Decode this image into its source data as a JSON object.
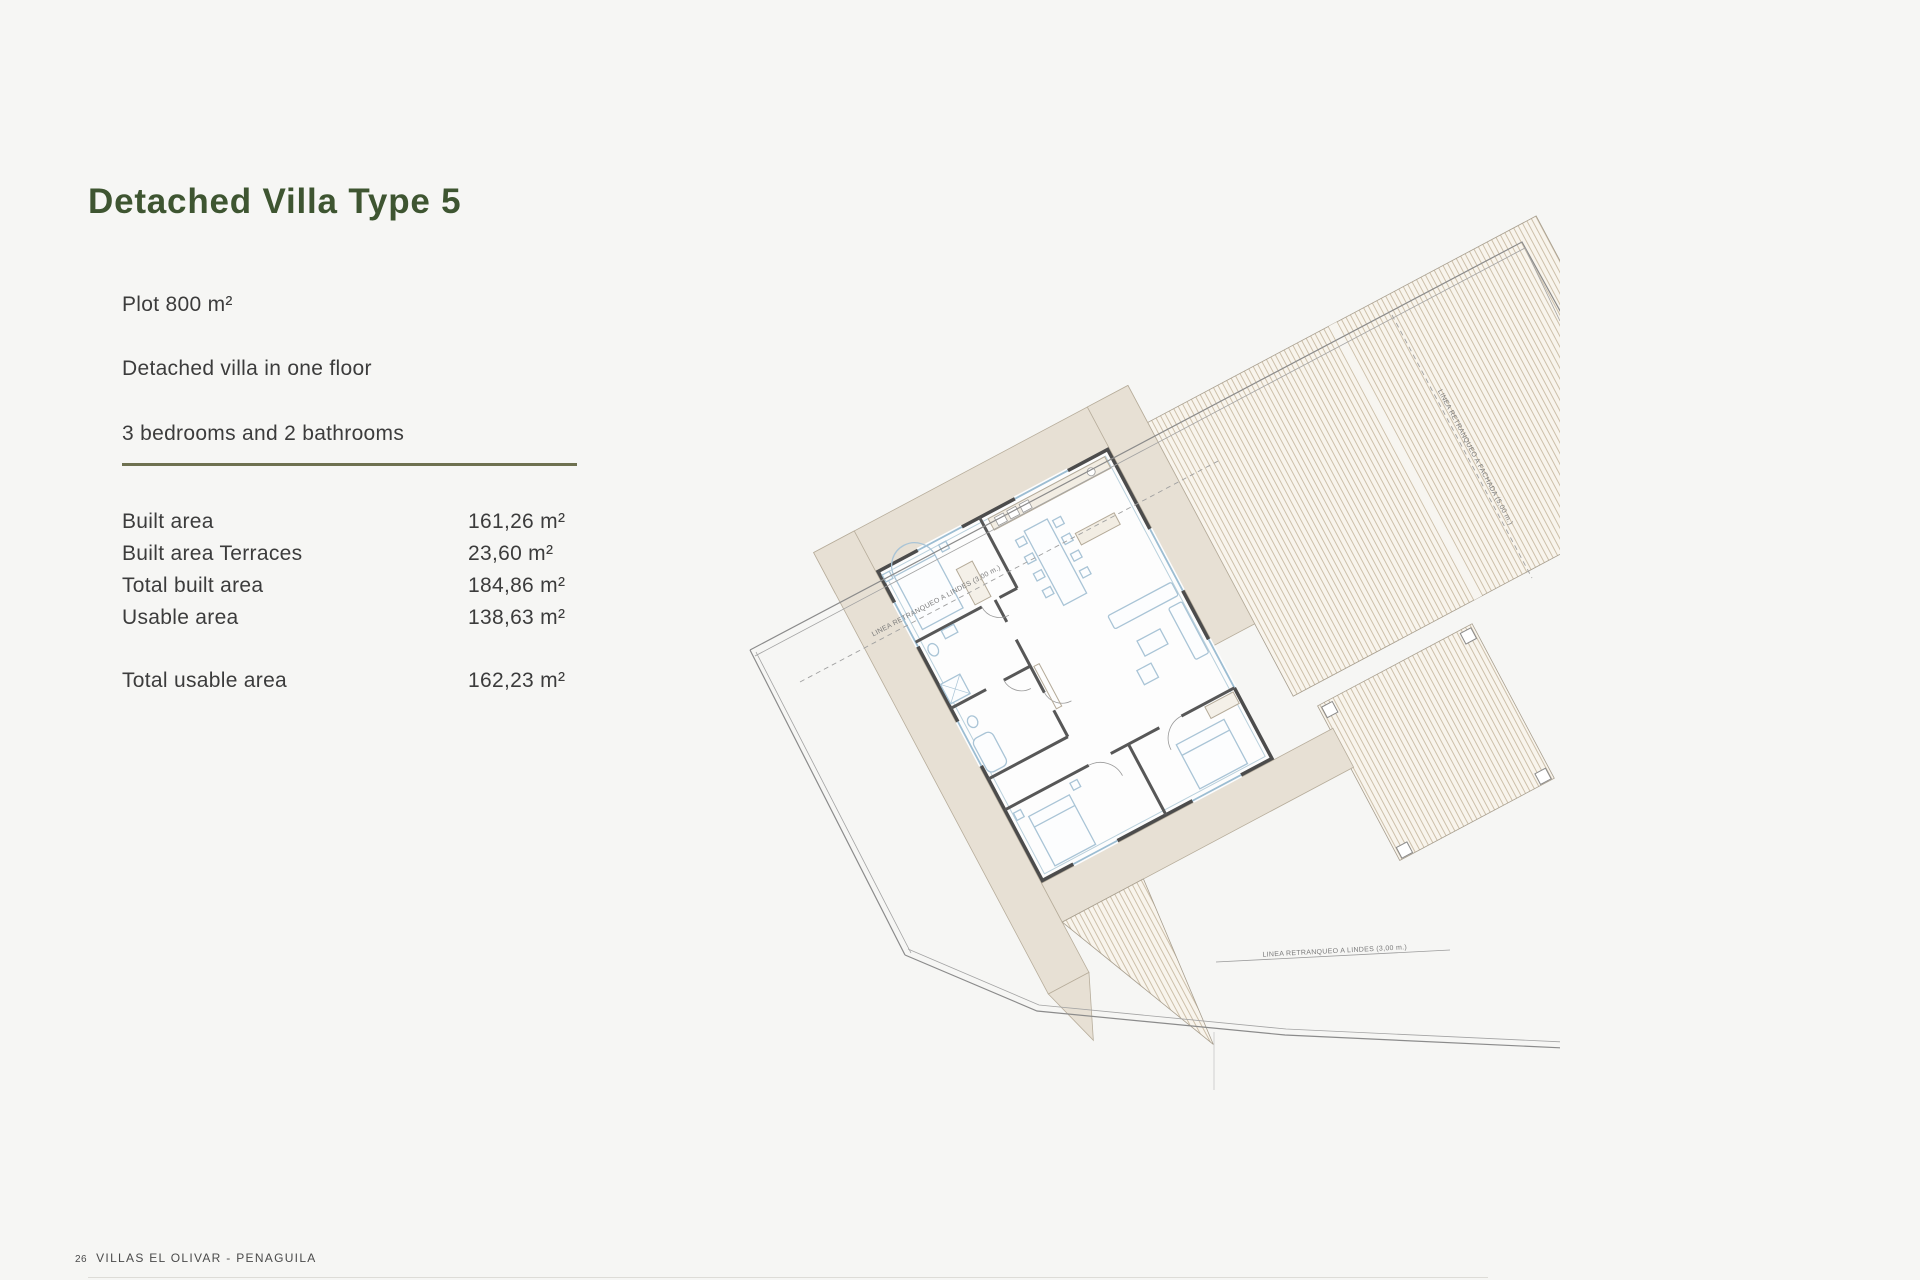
{
  "header": {
    "title": "Detached Villa Type 5"
  },
  "intro": {
    "plot": "Plot 800 m²",
    "floors": "Detached villa in one floor",
    "rooms": "3 bedrooms and 2 bathrooms"
  },
  "specs": {
    "rows": [
      {
        "label": "Built area",
        "value": "161,26 m²"
      },
      {
        "label": "Built area Terraces",
        "value": "23,60 m²"
      },
      {
        "label": "Total built area",
        "value": "184,86 m²"
      },
      {
        "label": "Usable area",
        "value": "138,63 m²"
      }
    ],
    "total": {
      "label": "Total usable area",
      "value": "162,23 m²"
    }
  },
  "plan": {
    "setback_side_label": "LINEA RETRANQUEO A LINDES (3,00 m.)",
    "setback_facade_label": "LINEA RETRANQUEO A FACHADA (5,00 m.)",
    "setback_bottom_label": "LINEA RETRANQUEO A LINDES (3,00 m.)"
  },
  "footer": {
    "page_number": "26",
    "project": "VILLAS EL OLIVAR - PENAGUILA"
  },
  "colors": {
    "accent_green": "#3e5531",
    "divider_olive": "#6e7150",
    "background": "#f6f6f4"
  }
}
